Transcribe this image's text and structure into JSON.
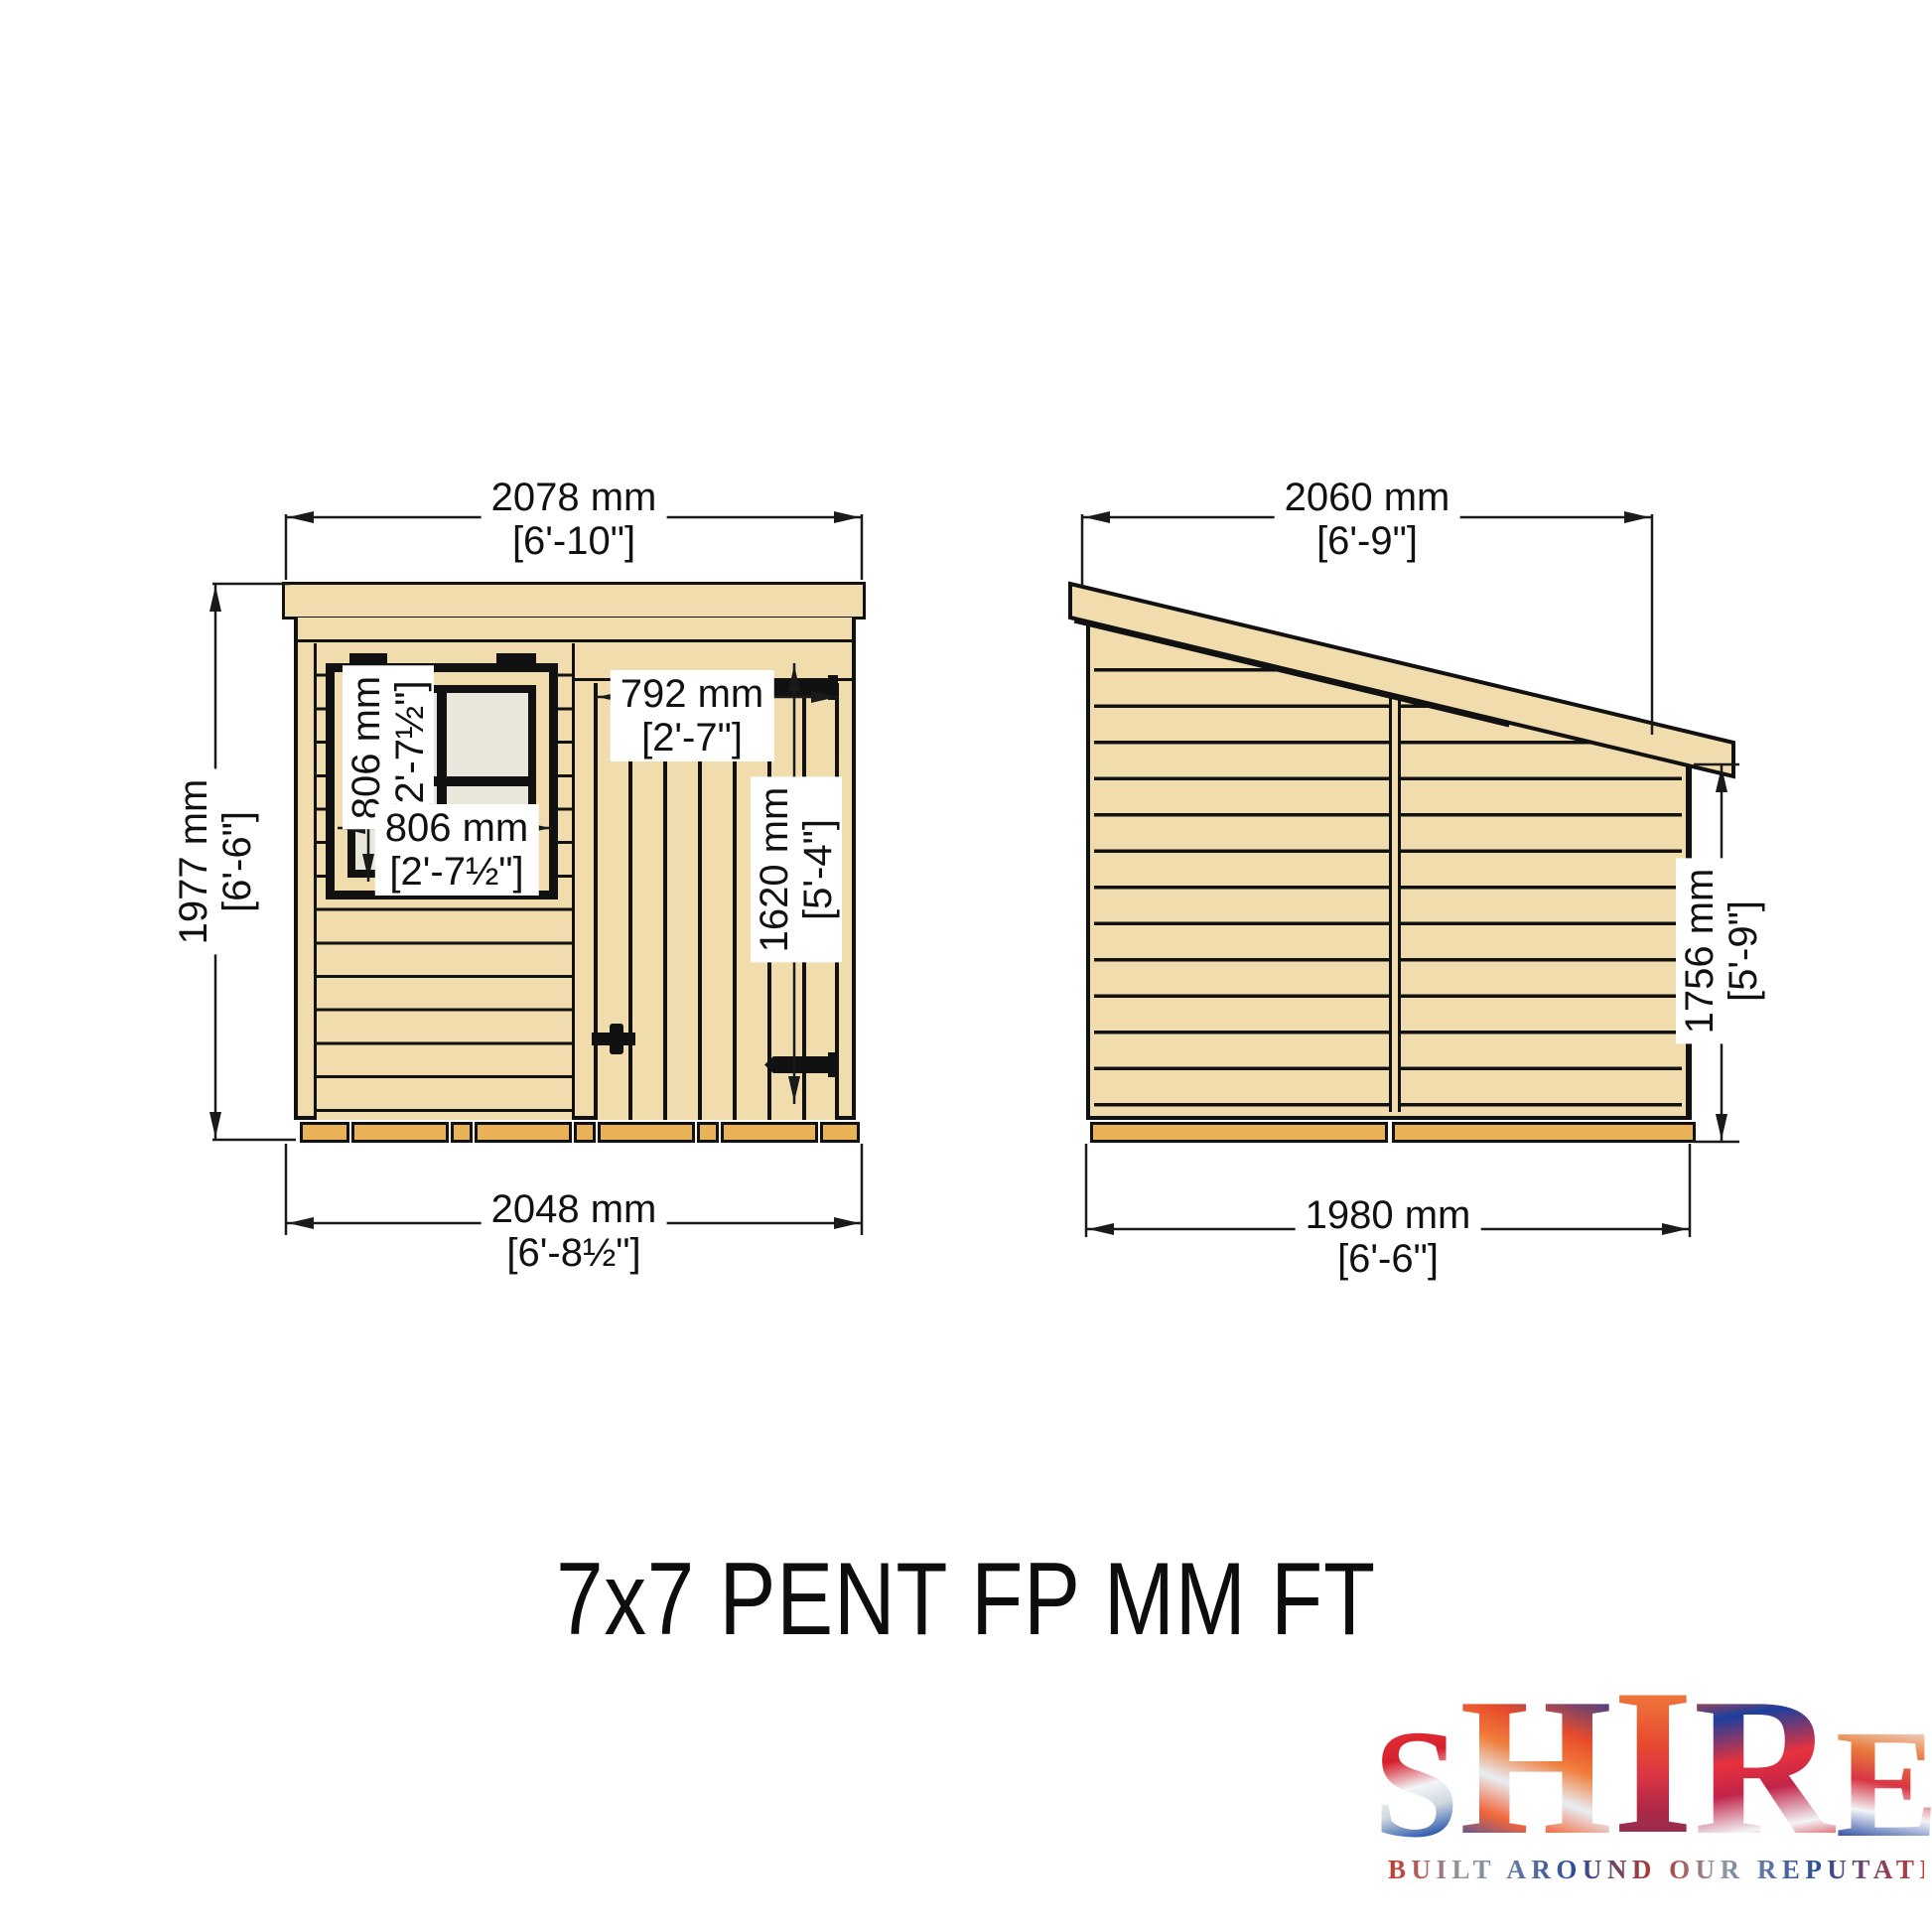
{
  "title": "7x7 PENT FP MM FT",
  "front": {
    "width": {
      "mm": "2078 mm",
      "ft": "[6'-10\"]"
    },
    "height": {
      "mm": "1977 mm",
      "ft": "[6'-6\"]"
    },
    "base": {
      "mm": "2048 mm",
      "ft": "[6'-8½\"]"
    },
    "window_h": {
      "mm": "806 mm",
      "ft": "[2'-7½\"]"
    },
    "window_w": {
      "mm": "806 mm",
      "ft": "[2'-7½\"]"
    },
    "door_w": {
      "mm": "792 mm",
      "ft": "[2'-7\"]"
    },
    "door_h": {
      "mm": "1620 mm",
      "ft": "[5'-4\"]"
    }
  },
  "side": {
    "width": {
      "mm": "2060 mm",
      "ft": "[6'-9\"]"
    },
    "height": {
      "mm": "1756 mm",
      "ft": "[5'-9\"]"
    },
    "base": {
      "mm": "1980 mm",
      "ft": "[6'-6\"]"
    }
  },
  "logo": {
    "brand": "SHIRE",
    "brand_letters": [
      "S",
      "H",
      "I",
      "R",
      "E"
    ],
    "tagline": "BUILT AROUND OUR REPUTATION"
  },
  "colors": {
    "wood": "#f1dcae",
    "skid": "#e9b257",
    "pane": "#e9e6db",
    "line": "#111111"
  }
}
